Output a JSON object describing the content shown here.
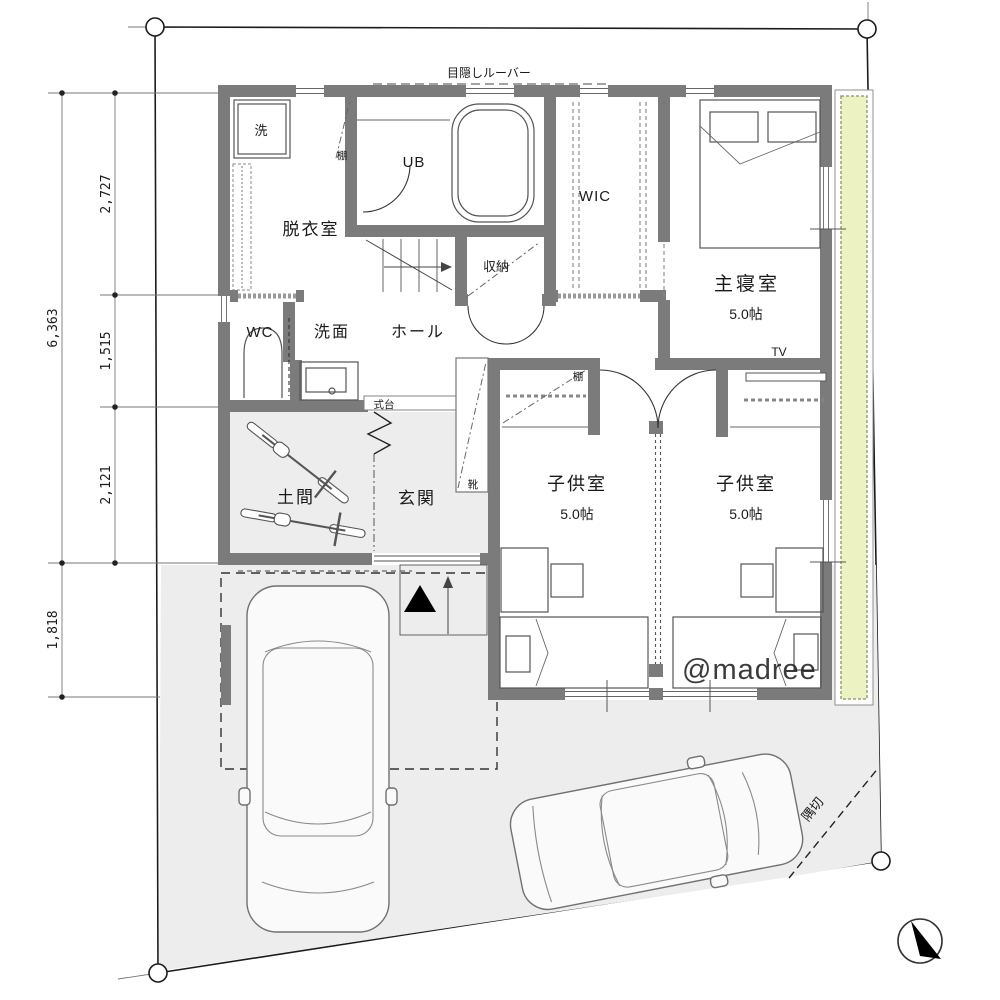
{
  "site": {
    "louver_label": "目隠しルーバー",
    "corner_cut_label": "隅切",
    "watermark": "@madree"
  },
  "dimensions": {
    "total_height": "6,363",
    "seg_top": "2,727",
    "seg_mid": "1,515",
    "seg_bottom": "2,121",
    "front_setback": "1,818"
  },
  "rooms": {
    "dressing_room": "脱衣室",
    "unit_bath": "UB",
    "walk_in_closet": "WIC",
    "master_bedroom": "主寝室",
    "master_size": "5.0帖",
    "toilet": "WC",
    "lavatory": "洗面",
    "hall": "ホール",
    "storage": "収納",
    "doma": "土間",
    "entrance": "玄関",
    "child_room_1": "子供室",
    "child_room_1_size": "5.0帖",
    "child_room_2": "子供室",
    "child_room_2_size": "5.0帖"
  },
  "fixtures": {
    "washer": "洗",
    "shelf_dressing": "棚",
    "shelf_child": "棚",
    "step": "式台",
    "shoe_cabinet": "靴",
    "tv": "TV"
  },
  "colors": {
    "wall": "#7b7b7b",
    "ground": "#ededed",
    "deck": "#edf2c3",
    "watermark": "#989898"
  }
}
